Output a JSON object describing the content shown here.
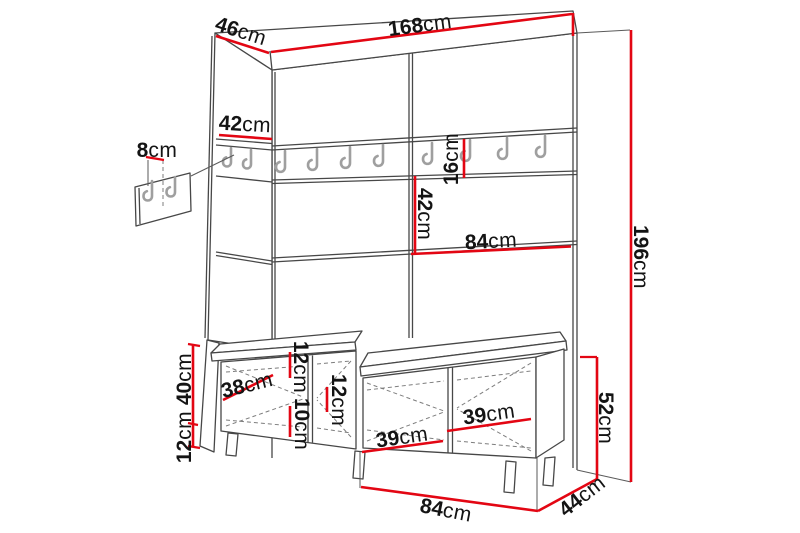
{
  "colors": {
    "dimension_red": "#e30613",
    "line_gray": "#474747",
    "hook_gray": "#9f9f9f"
  },
  "hooks": {
    "front_rail_count": 8,
    "side_panel_count": 2,
    "wall_panel_count": 2
  },
  "dimensions": {
    "top_width": {
      "num": "168",
      "unit": "cm"
    },
    "side_depth": {
      "num": "46",
      "unit": "cm"
    },
    "hook_panel_width": {
      "num": "42",
      "unit": "cm"
    },
    "wall_panel_height": {
      "num": "8",
      "unit": "cm"
    },
    "rail_height": {
      "num": "16",
      "unit": "cm"
    },
    "niche_height": {
      "num": "42",
      "unit": "cm"
    },
    "niche_width": {
      "num": "84",
      "unit": "cm"
    },
    "total_height": {
      "num": "196",
      "unit": "cm"
    },
    "bench_body_height": {
      "num": "40",
      "unit": "cm"
    },
    "leg_height": {
      "num": "12",
      "unit": "cm"
    },
    "door_width": {
      "num": "38",
      "unit": "cm"
    },
    "clearance_upper": {
      "num": "12",
      "unit": "cm"
    },
    "clearance_lower": {
      "num": "10",
      "unit": "cm"
    },
    "clearance_right": {
      "num": "12",
      "unit": "cm"
    },
    "shelf_width_front": {
      "num": "39",
      "unit": "cm"
    },
    "shelf_width_inner": {
      "num": "39",
      "unit": "cm"
    },
    "bench_total_height": {
      "num": "52",
      "unit": "cm"
    },
    "bench_width": {
      "num": "84",
      "unit": "cm"
    },
    "bench_depth": {
      "num": "44",
      "unit": "cm"
    }
  }
}
